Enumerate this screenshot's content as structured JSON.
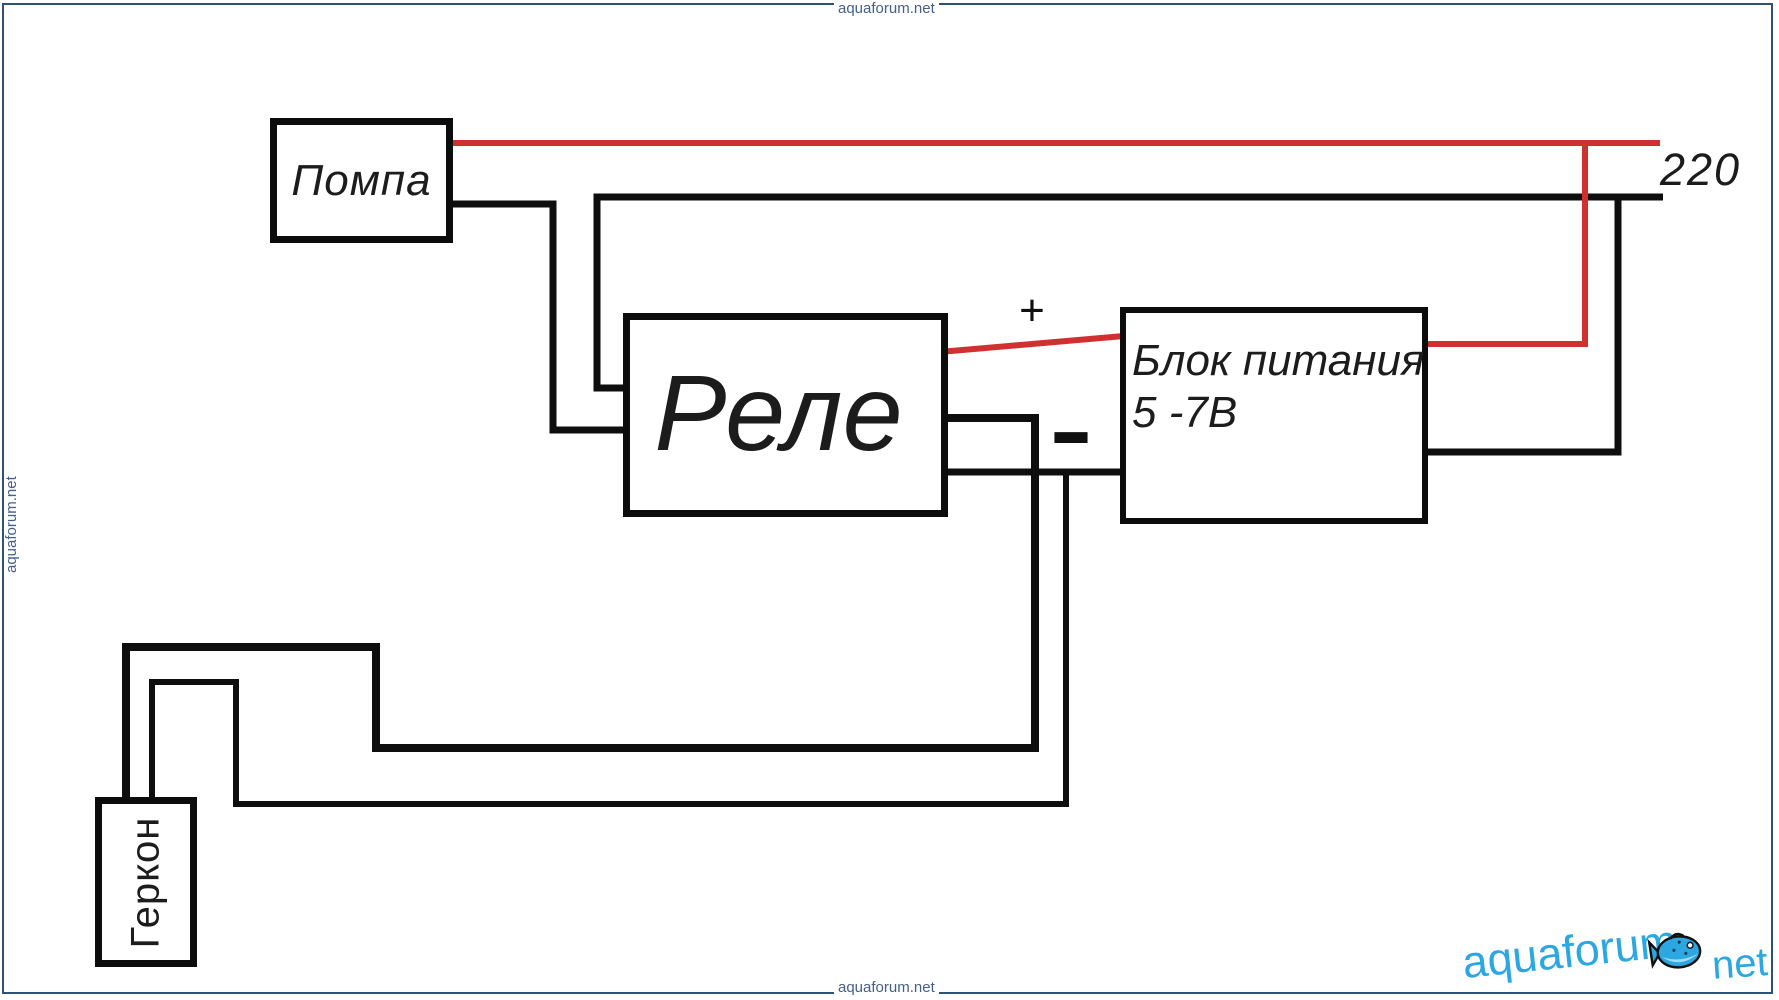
{
  "page": {
    "width": 1779,
    "height": 1000,
    "background": "#ffffff"
  },
  "frame": {
    "color": "#2f5377"
  },
  "colors": {
    "wire_black": "#0e0e0e",
    "wire_red": "#d03030",
    "label_text": "#1c1c1c",
    "watermark": "#44608a",
    "logo_blue": "#2ba7e2"
  },
  "boxes": {
    "pump": {
      "label": "Помпа"
    },
    "relay": {
      "label": "Реле"
    },
    "psu": {
      "label_line1": "Блок питания",
      "label_line2": "5 -7В"
    },
    "reed": {
      "label": "Геркон"
    }
  },
  "labels": {
    "plus": "+",
    "minus": "−",
    "mains_voltage": "220"
  },
  "watermark": {
    "text": "aquaforum.net"
  },
  "logo": {
    "word1": "aquaforum",
    "word2": "net"
  }
}
